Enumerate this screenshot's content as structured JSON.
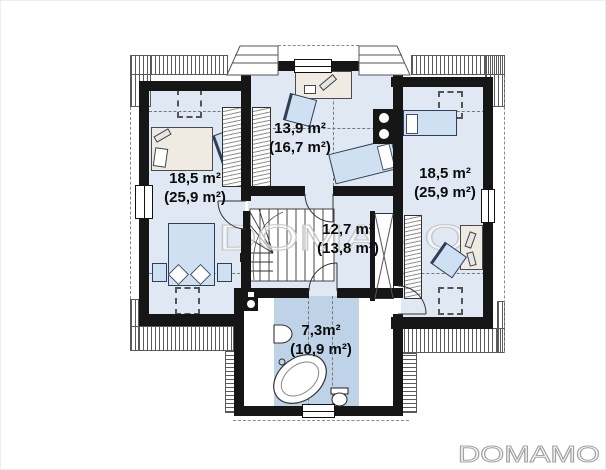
{
  "page": {
    "background": "#ffffff"
  },
  "watermark": {
    "plan_text": "DOMAMO",
    "logo_text": "DOMAMO",
    "plan_color": "#c6c6c6",
    "logo_color": "#a3a3a3"
  },
  "rooms": [
    {
      "id": "left-bedroom",
      "area": "18,5 m²",
      "area_total": "(25,9 m²)"
    },
    {
      "id": "top-bedroom",
      "area": "13,9 m²",
      "area_total": "(16,7 m²)"
    },
    {
      "id": "right-bedroom",
      "area": "18,5 m²",
      "area_total": "(25,9 m²)"
    },
    {
      "id": "hall",
      "area": "12,7 m²",
      "area_total": "(13,8 m²)"
    },
    {
      "id": "bathroom",
      "area": "7,3m²",
      "area_total": "(10,9 m²)"
    }
  ],
  "colors": {
    "wall": "#161616",
    "room_fill": "#dfe8f3",
    "bath_fill": "#bed3e8",
    "furniture_fill": "#cfe0f3",
    "desk_fill": "#efebe2"
  }
}
